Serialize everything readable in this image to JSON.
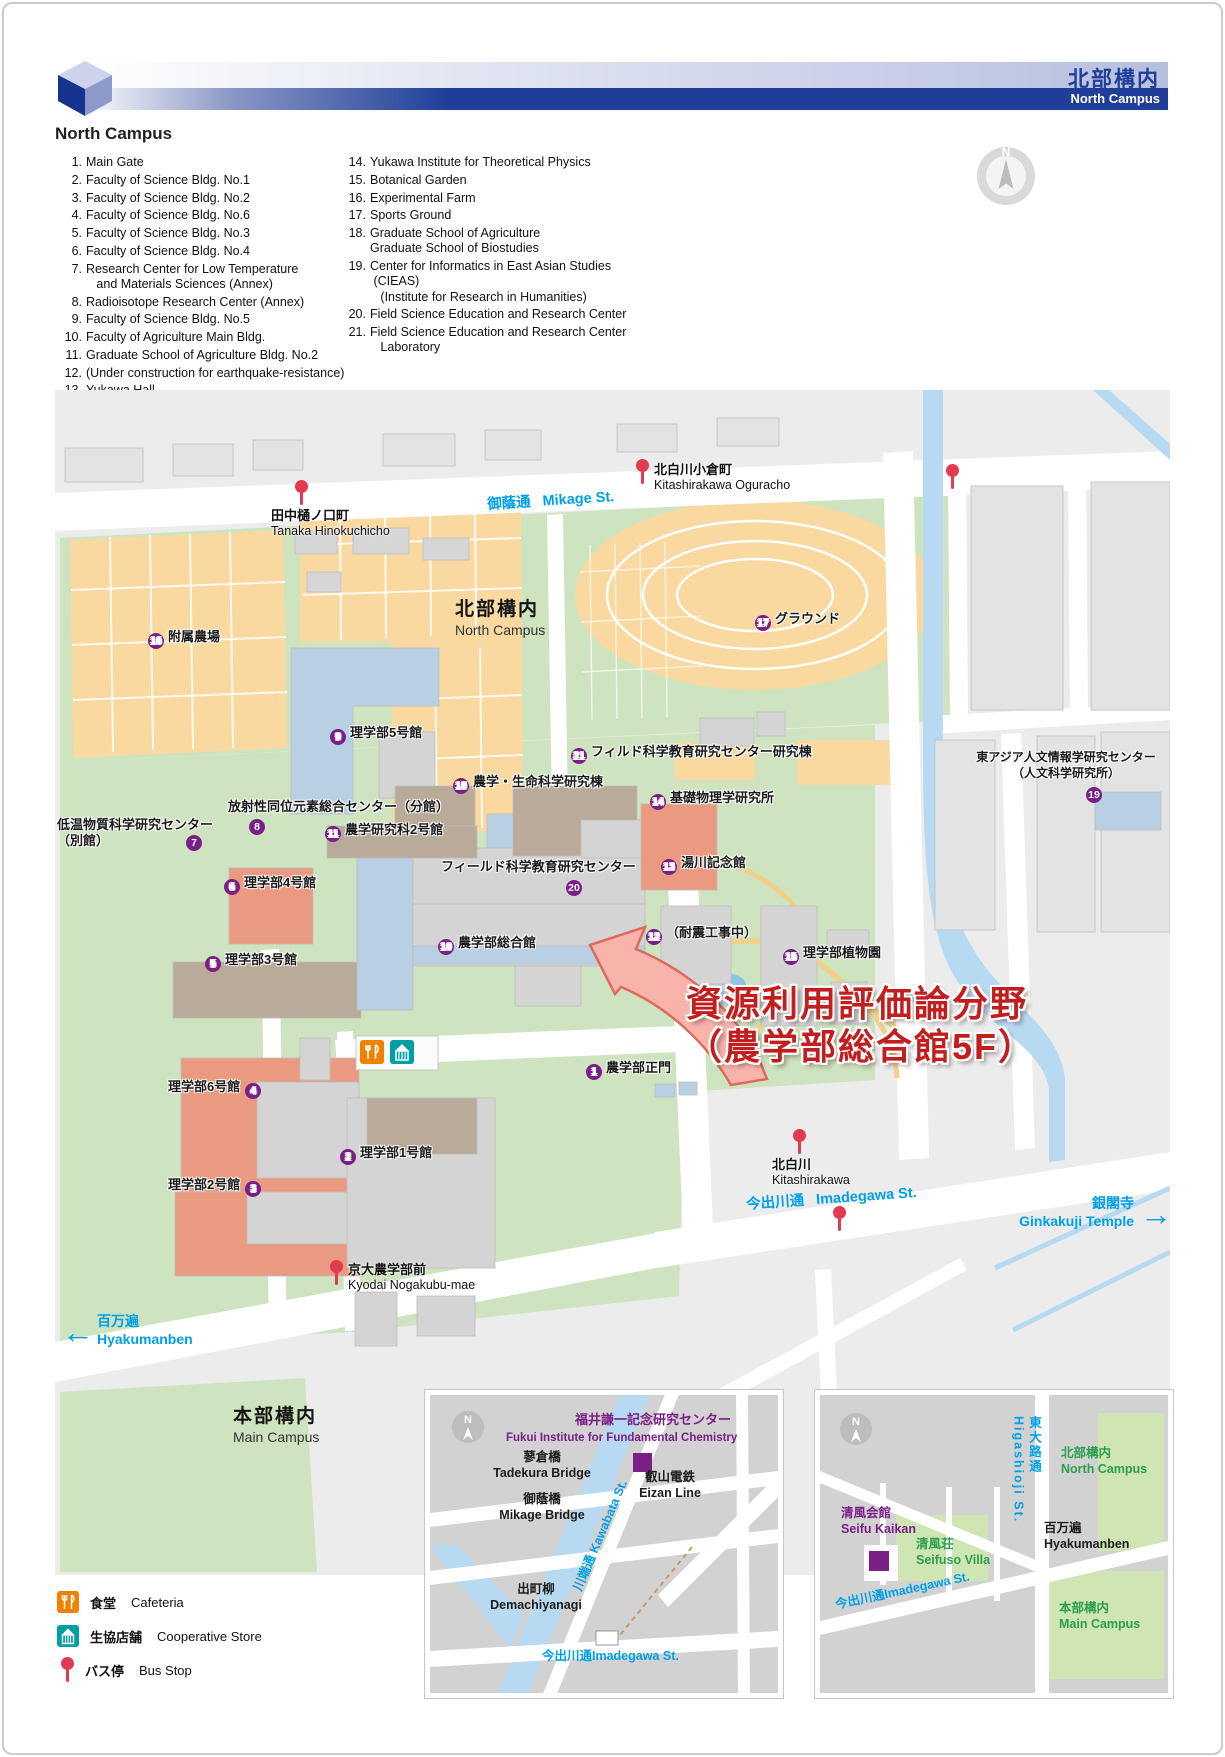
{
  "header": {
    "title_jp": "北部構内",
    "title_en": "North Campus"
  },
  "list": {
    "heading": "North Campus",
    "col1": [
      {
        "no": "1.",
        "text": "Main Gate"
      },
      {
        "no": "2.",
        "text": "Faculty of Science Bldg. No.1"
      },
      {
        "no": "3.",
        "text": "Faculty of Science Bldg. No.2"
      },
      {
        "no": "4.",
        "text": "Faculty of Science Bldg. No.6"
      },
      {
        "no": "5.",
        "text": "Faculty of Science Bldg. No.3"
      },
      {
        "no": "6.",
        "text": "Faculty of Science Bldg. No.4"
      },
      {
        "no": "7.",
        "text": "Research Center for Low Temperature\n   and Materials Sciences (Annex)"
      },
      {
        "no": "8.",
        "text": "Radioisotope Research Center (Annex)"
      },
      {
        "no": "9.",
        "text": "Faculty of Science Bldg. No.5"
      },
      {
        "no": "10.",
        "text": "Faculty of Agriculture Main Bldg."
      },
      {
        "no": "11.",
        "text": "Graduate School of Agriculture Bldg. No.2"
      },
      {
        "no": "12.",
        "text": "(Under construction for earthquake-resistance)"
      },
      {
        "no": "13.",
        "text": "Yukawa Hall"
      }
    ],
    "col2": [
      {
        "no": "14.",
        "text": "Yukawa Institute for Theoretical Physics"
      },
      {
        "no": "15.",
        "text": "Botanical Garden"
      },
      {
        "no": "16.",
        "text": "Experimental Farm"
      },
      {
        "no": "17.",
        "text": "Sports Ground"
      },
      {
        "no": "18.",
        "text": "Graduate School of Agriculture\nGraduate School of Biostudies"
      },
      {
        "no": "19.",
        "text": "Center for Informatics in East Asian Studies\n (CIEAS)\n   (Institute for Research in Humanities)"
      },
      {
        "no": "20.",
        "text": "Field Science Education and Research Center"
      },
      {
        "no": "21.",
        "text": "Field Science Education and Research Center\n   Laboratory"
      }
    ]
  },
  "map": {
    "labels": [
      {
        "id": "farm",
        "num": "16",
        "text": "附属農場",
        "x": 148,
        "y": 629,
        "layout": "left"
      },
      {
        "id": "sports-ground",
        "num": "17",
        "text": "グラウンド",
        "x": 755,
        "y": 611,
        "layout": "left"
      },
      {
        "id": "science-5",
        "num": "9",
        "text": "理学部5号館",
        "x": 330,
        "y": 725,
        "layout": "left"
      },
      {
        "id": "field-sci-lab",
        "num": "21",
        "text": "フィルド科学教育研究センター研究棟",
        "x": 571,
        "y": 744,
        "layout": "left"
      },
      {
        "id": "agri-life",
        "num": "18",
        "text": "農学・生命科学研究棟",
        "x": 453,
        "y": 774,
        "layout": "left"
      },
      {
        "id": "yukawa-inst",
        "num": "14",
        "text": "基礎物理学研究所",
        "x": 650,
        "y": 790,
        "layout": "left"
      },
      {
        "id": "agri-2",
        "num": "11",
        "text": "農学研究科2号館",
        "x": 325,
        "y": 822,
        "layout": "left"
      },
      {
        "id": "yukawa-hall",
        "num": "13",
        "text": "湯川記念館",
        "x": 661,
        "y": 855,
        "layout": "left"
      },
      {
        "id": "science-4",
        "num": "6",
        "text": "理学部4号館",
        "x": 224,
        "y": 875,
        "layout": "left"
      },
      {
        "id": "agri-main",
        "num": "10",
        "text": "農学部総合館",
        "x": 438,
        "y": 935,
        "layout": "left"
      },
      {
        "id": "construction",
        "num": "12",
        "text": "（耐震工事中）",
        "x": 646,
        "y": 925,
        "layout": "left"
      },
      {
        "id": "botanical",
        "num": "15",
        "text": "理学部植物園",
        "x": 783,
        "y": 945,
        "layout": "left"
      },
      {
        "id": "science-3",
        "num": "5",
        "text": "理学部3号館",
        "x": 205,
        "y": 952,
        "layout": "left"
      },
      {
        "id": "main-gate",
        "num": "1",
        "text": "農学部正門",
        "x": 586,
        "y": 1060,
        "layout": "left"
      },
      {
        "id": "science-6",
        "num": "4",
        "text": "理学部6号館",
        "x": 168,
        "y": 1079,
        "layout": "right"
      },
      {
        "id": "science-1",
        "num": "2",
        "text": "理学部1号館",
        "x": 340,
        "y": 1145,
        "layout": "left"
      },
      {
        "id": "science-2",
        "num": "3",
        "text": "理学部2号館",
        "x": 168,
        "y": 1177,
        "layout": "right"
      },
      {
        "id": "radioisotope",
        "text": "放射性同位元素総合センター（分館）",
        "x": 228,
        "y": 799,
        "layout": "none"
      },
      {
        "id": "low-temp",
        "text": "低温物質科学研究センター\n（別館）",
        "x": 57,
        "y": 817,
        "layout": "none"
      },
      {
        "id": "field-sci",
        "text": "フィールド科学教育研究センター",
        "x": 441,
        "y": 859,
        "layout": "none"
      },
      {
        "id": "cieas",
        "text": "東アジア人文情報学研究センター\n（人文科学研究所）",
        "x": 960,
        "y": 749,
        "layout": "none",
        "cls": "small center",
        "w": 212
      }
    ],
    "badges": [
      {
        "num": "8",
        "x": 249,
        "y": 819
      },
      {
        "num": "7",
        "x": 186,
        "y": 835
      },
      {
        "num": "20",
        "x": 566,
        "y": 880
      },
      {
        "num": "19",
        "x": 1086,
        "y": 787
      }
    ],
    "bus_stops": [
      {
        "id": "kitashirakawa-oguracho",
        "jp": "北白川小倉町",
        "en": "Kitashirakawa Oguracho",
        "pin_x": 636,
        "pin_y": 459,
        "text_x": 654,
        "text_y": 462
      },
      {
        "id": "tanaka-hinokuchicho",
        "jp": "田中樋ノ口町",
        "en": "Tanaka Hinokuchicho",
        "pin_x": 295,
        "pin_y": 480,
        "text_x": 271,
        "text_y": 508
      },
      {
        "id": "kitashirakawa",
        "jp": "北白川",
        "en": "Kitashirakawa",
        "pin_x": 793,
        "pin_y": 1129,
        "text_x": 772,
        "text_y": 1157
      },
      {
        "id": "kyodai-nogakubu-mae",
        "jp": "京大農学部前",
        "en": "Kyodai Nogakubu-mae",
        "pin_x": 330,
        "pin_y": 1260,
        "text_x": 348,
        "text_y": 1262
      }
    ],
    "pins": [
      {
        "x": 946,
        "y": 464
      },
      {
        "x": 833,
        "y": 1206
      }
    ],
    "street_labels": [
      {
        "id": "mikage-st",
        "jp": "御蔭通",
        "en": "Mikage St.",
        "x": 487,
        "y": 489,
        "rot": -3.5
      },
      {
        "id": "imadegawa-st",
        "jp": "今出川通",
        "en": "Imadegawa St.",
        "x": 746,
        "y": 1187,
        "rot": -4
      }
    ],
    "directions": [
      {
        "id": "ginkakuji",
        "jp": "銀閣寺",
        "en": "Ginkakuji Temple",
        "x": 1002,
        "y": 1194,
        "w": 132,
        "align": "right",
        "arrow": "→",
        "ax": 1140,
        "ay": 1198
      },
      {
        "id": "hyakumanben",
        "jp": "百万遍",
        "en": "Hyakumanben",
        "x": 97,
        "y": 1312,
        "w": 130,
        "align": "left",
        "arrow": "←",
        "ax": 62,
        "ay": 1316
      }
    ],
    "areas": [
      {
        "id": "north-campus-title",
        "jp": "北部構内",
        "en": "North Campus",
        "x": 455,
        "y": 594
      },
      {
        "id": "main-campus-title",
        "jp": "本部構内",
        "en": "Main Campus",
        "x": 233,
        "y": 1401
      }
    ],
    "highlight": {
      "line1": "資源利用評価論分野",
      "line2": "（農学部総合館5F）",
      "x": 686,
      "y": 982
    },
    "legend": [
      {
        "type": "cafeteria",
        "jp": "食堂",
        "en": "Cafeteria"
      },
      {
        "type": "coop",
        "jp": "生協店舗",
        "en": "Cooperative Store"
      },
      {
        "type": "bus",
        "jp": "バス停",
        "en": "Bus Stop"
      }
    ]
  },
  "inset1": {
    "texts": [
      {
        "id": "fukui-jp",
        "text": "福井謙一記念研究センター",
        "x": 575,
        "y": 1412,
        "cls": "purple jp13"
      },
      {
        "id": "fukui-en",
        "text": "Fukui Institute for Fundamental Chemistry",
        "x": 506,
        "y": 1431,
        "cls": "purple en115"
      },
      {
        "id": "tadekura",
        "text": "蓼倉橋\nTadekura Bridge",
        "x": 488,
        "y": 1450,
        "cls": "center",
        "w": 108
      },
      {
        "id": "mikage-bridge",
        "text": "御蔭橋\nMikage Bridge",
        "x": 486,
        "y": 1492,
        "cls": "center",
        "w": 112
      },
      {
        "id": "eizan-line",
        "text": "叡山電鉄\nEizan Line",
        "x": 624,
        "y": 1470,
        "cls": "center",
        "w": 92
      },
      {
        "id": "kawabata-st",
        "text": "川端通 Kawabata St.",
        "x": 585,
        "y": 1578,
        "cls": "blue rot67"
      },
      {
        "id": "demachiyanagi",
        "text": "出町柳\nDemachiyanagi",
        "x": 478,
        "y": 1582,
        "cls": "center",
        "w": 116
      },
      {
        "id": "imadegawa-1",
        "text": "今出川通Imadegawa St.",
        "x": 542,
        "y": 1649,
        "cls": "blue"
      }
    ]
  },
  "inset2": {
    "texts": [
      {
        "id": "higashioji-st",
        "text": "東大路通\nHigashioji St.",
        "x": 1010,
        "y": 1416,
        "cls": "blue vertical"
      },
      {
        "id": "north-campus2",
        "text": "北部構内\nNorth Campus",
        "x": 1061,
        "y": 1446,
        "cls": "green"
      },
      {
        "id": "seifu-kaikan",
        "text": "清風会館\nSeifu Kaikan",
        "x": 841,
        "y": 1506,
        "cls": "purple"
      },
      {
        "id": "seifuso-villa",
        "text": "清風荘\nSeifuso Villa",
        "x": 916,
        "y": 1537,
        "cls": "green"
      },
      {
        "id": "hyakumanben2",
        "text": "百万遍\nHyakumanben",
        "x": 1044,
        "y": 1521,
        "cls": ""
      },
      {
        "id": "imadegawa-2",
        "text": "今出川通Imadegawa St.",
        "x": 834,
        "y": 1598,
        "cls": "blue rotm13"
      },
      {
        "id": "main-campus2",
        "text": "本部構内\nMain Campus",
        "x": 1059,
        "y": 1601,
        "cls": "green"
      }
    ]
  },
  "colors": {
    "header_blue": "#1e3e99",
    "badge_purple": "#7a1f86",
    "pin_red": "#e23a50",
    "street_blue": "#00a0e8",
    "highlight_red": "#c21e1e",
    "green_text": "#2aa04a",
    "cafeteria_orange": "#ef8200",
    "coop_teal": "#00a0a2",
    "campus_green": "#cee3bf",
    "farm_orange": "#f9d9a0",
    "river_blue": "#b7d9f2"
  }
}
